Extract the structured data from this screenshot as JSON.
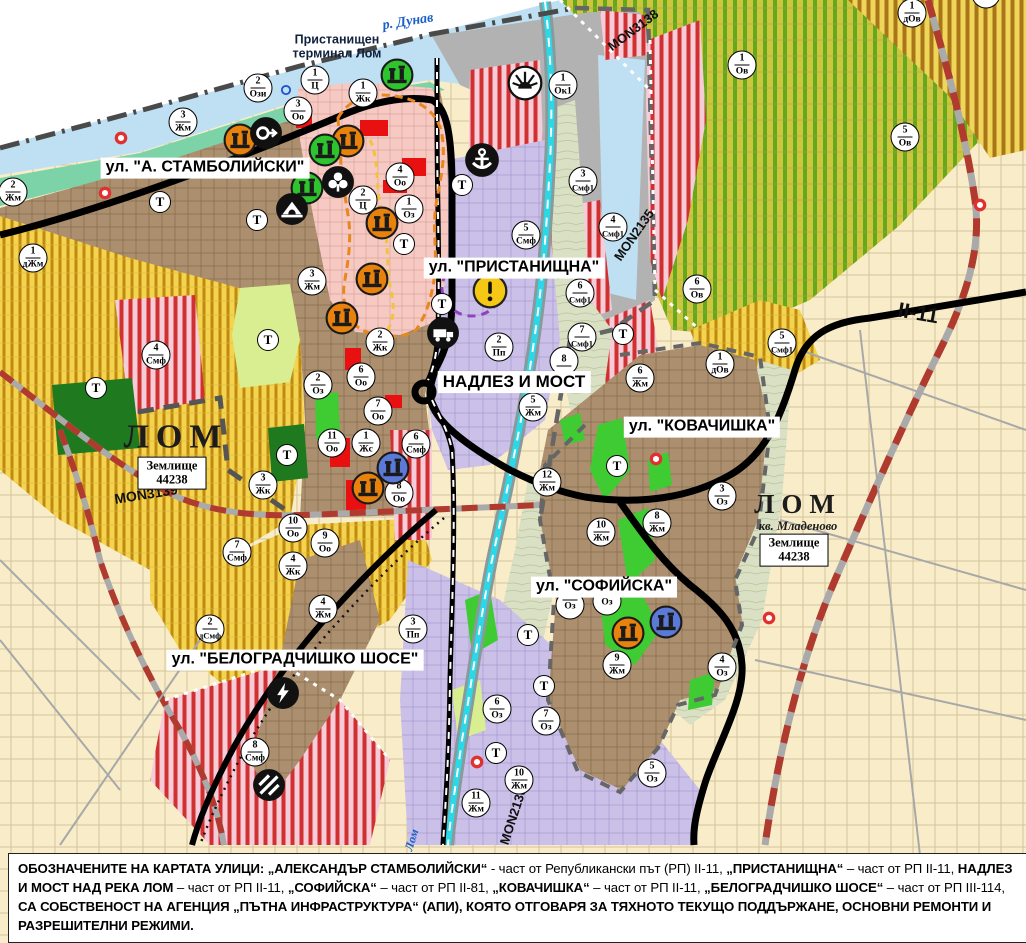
{
  "map": {
    "street_labels": [
      {
        "t": "ул. \"А. СТАМБОЛИЙСКИ\"",
        "x": 205,
        "y": 168,
        "fs": 16
      },
      {
        "t": "ул. \"ПРИСТАНИЩНА\"",
        "x": 514,
        "y": 268,
        "fs": 16
      },
      {
        "t": "НАДЛЕЗ И МОСТ",
        "x": 514,
        "y": 382,
        "fs": 17
      },
      {
        "t": "ул. \"КОВАЧИШКА\"",
        "x": 702,
        "y": 427,
        "fs": 16
      },
      {
        "t": "ул. \"СОФИЙСКА\"",
        "x": 604,
        "y": 587,
        "fs": 16
      },
      {
        "t": "ул. \"БЕЛОГРАДЧИШКО ШОСЕ\"",
        "x": 295,
        "y": 660,
        "fs": 16
      }
    ],
    "road_labels": [
      {
        "t": "MON3138",
        "x": 633,
        "y": 30,
        "rot": -37,
        "fs": 13
      },
      {
        "t": "MON2135",
        "x": 634,
        "y": 235,
        "rot": -55,
        "fs": 13
      },
      {
        "t": "MON3139",
        "x": 146,
        "y": 494,
        "rot": -9,
        "fs": 14
      },
      {
        "t": "MON2136",
        "x": 513,
        "y": 816,
        "rot": -72,
        "fs": 13
      },
      {
        "t": "II-11",
        "x": 918,
        "y": 314,
        "rot": 10,
        "fs": 21
      }
    ],
    "text_labels": [
      {
        "t": "р. Дунав",
        "x": 408,
        "y": 22,
        "rot": -9,
        "cls": "river",
        "fs": 14
      },
      {
        "t": "Пристанищен\nтерминал Лом",
        "x": 337,
        "y": 47,
        "rot": 0,
        "cls": "terminal",
        "fs": 12.5
      },
      {
        "t": "ЛОМ",
        "x": 176,
        "y": 437,
        "rot": 0,
        "cls": "city",
        "fs": 34
      },
      {
        "t": "ЛОМ",
        "x": 798,
        "y": 505,
        "rot": 0,
        "cls": "city",
        "fs": 27
      },
      {
        "t": "кв. Младеново",
        "x": 798,
        "y": 527,
        "rot": 0,
        "cls": "district",
        "fs": 12.5
      },
      {
        "t": "Лом",
        "x": 412,
        "y": 840,
        "rot": -73,
        "cls": "river",
        "fs": 12
      }
    ],
    "boxed_labels": [
      {
        "t": "Землище\n44238",
        "x": 172,
        "y": 473
      },
      {
        "t": "Землище\n44238",
        "x": 794,
        "y": 550
      }
    ],
    "t_label": "Т",
    "t_markers": [
      [
        160,
        202
      ],
      [
        257,
        220
      ],
      [
        462,
        185
      ],
      [
        404,
        244
      ],
      [
        442,
        304
      ],
      [
        268,
        340
      ],
      [
        96,
        388
      ],
      [
        287,
        455
      ],
      [
        623,
        334
      ],
      [
        617,
        466
      ],
      [
        528,
        635
      ],
      [
        544,
        686
      ],
      [
        496,
        753
      ]
    ],
    "zone_markers": [
      {
        "n": "2",
        "c": "Ози",
        "x": 258,
        "y": 88
      },
      {
        "n": "1",
        "c": "Ц",
        "x": 315,
        "y": 80
      },
      {
        "n": "1",
        "c": "Жк",
        "x": 363,
        "y": 93
      },
      {
        "n": "3",
        "c": "Оо",
        "x": 298,
        "y": 111
      },
      {
        "n": "3",
        "c": "Жм",
        "x": 183,
        "y": 122
      },
      {
        "n": "2",
        "c": "Жм",
        "x": 13,
        "y": 192
      },
      {
        "n": "1",
        "c": "дЖм",
        "x": 33,
        "y": 258
      },
      {
        "n": "4",
        "c": "Оо",
        "x": 400,
        "y": 177
      },
      {
        "n": "2",
        "c": "Ц",
        "x": 363,
        "y": 200
      },
      {
        "n": "1",
        "c": "Оз",
        "x": 409,
        "y": 209
      },
      {
        "n": "3",
        "c": "Жм",
        "x": 312,
        "y": 281
      },
      {
        "n": "1",
        "c": "Ок1",
        "x": 563,
        "y": 85
      },
      {
        "n": "1",
        "c": "Ов",
        "x": 742,
        "y": 65
      },
      {
        "n": "5",
        "c": "Ов",
        "x": 905,
        "y": 137
      },
      {
        "n": "1",
        "c": "дОв",
        "x": 912,
        "y": 13
      },
      {
        "n": "",
        "c": "дОв",
        "x": 986,
        "y": -6
      },
      {
        "n": "3",
        "c": "Смф1",
        "x": 583,
        "y": 181
      },
      {
        "n": "4",
        "c": "Смф1",
        "x": 613,
        "y": 227
      },
      {
        "n": "5",
        "c": "Смф",
        "x": 526,
        "y": 235
      },
      {
        "n": "6",
        "c": "Ов",
        "x": 697,
        "y": 289
      },
      {
        "n": "5",
        "c": "Смф1",
        "x": 782,
        "y": 343
      },
      {
        "n": "1",
        "c": "дОв",
        "x": 720,
        "y": 364
      },
      {
        "n": "6",
        "c": "Смф1",
        "x": 580,
        "y": 293
      },
      {
        "n": "7",
        "c": "Смф1",
        "x": 582,
        "y": 337
      },
      {
        "n": "2",
        "c": "Пп",
        "x": 499,
        "y": 347
      },
      {
        "n": "8",
        "c": "",
        "x": 564,
        "y": 361
      },
      {
        "n": "5",
        "c": "Жм",
        "x": 533,
        "y": 407
      },
      {
        "n": "6",
        "c": "Жм",
        "x": 640,
        "y": 378
      },
      {
        "n": "2",
        "c": "Оз",
        "x": 318,
        "y": 385
      },
      {
        "n": "6",
        "c": "Оо",
        "x": 361,
        "y": 377
      },
      {
        "n": "2",
        "c": "Жк",
        "x": 380,
        "y": 342
      },
      {
        "n": "7",
        "c": "Оо",
        "x": 378,
        "y": 411
      },
      {
        "n": "11",
        "c": "Оо",
        "x": 332,
        "y": 443
      },
      {
        "n": "1",
        "c": "Жс",
        "x": 366,
        "y": 443
      },
      {
        "n": "6",
        "c": "Смф",
        "x": 416,
        "y": 444
      },
      {
        "n": "8",
        "c": "Оо",
        "x": 399,
        "y": 493
      },
      {
        "n": "3",
        "c": "Жк",
        "x": 263,
        "y": 485
      },
      {
        "n": "10",
        "c": "Оо",
        "x": 293,
        "y": 528
      },
      {
        "n": "9",
        "c": "Оо",
        "x": 325,
        "y": 543
      },
      {
        "n": "4",
        "c": "Жк",
        "x": 293,
        "y": 566
      },
      {
        "n": "7",
        "c": "Смф",
        "x": 237,
        "y": 552
      },
      {
        "n": "4",
        "c": "Смф",
        "x": 156,
        "y": 355
      },
      {
        "n": "12",
        "c": "Жм",
        "x": 547,
        "y": 482
      },
      {
        "n": "3",
        "c": "Оз",
        "x": 722,
        "y": 496
      },
      {
        "n": "8",
        "c": "Жм",
        "x": 657,
        "y": 523
      },
      {
        "n": "10",
        "c": "Жм",
        "x": 601,
        "y": 532
      },
      {
        "n": "9",
        "c": "Жм",
        "x": 617,
        "y": 665
      },
      {
        "n": "4",
        "c": "Оз",
        "x": 722,
        "y": 667
      },
      {
        "n": "6",
        "c": "Оз",
        "x": 497,
        "y": 709
      },
      {
        "n": "7",
        "c": "Оз",
        "x": 546,
        "y": 721
      },
      {
        "n": "10",
        "c": "Жм",
        "x": 519,
        "y": 780
      },
      {
        "n": "11",
        "c": "Жм",
        "x": 476,
        "y": 803
      },
      {
        "n": "5",
        "c": "Оз",
        "x": 652,
        "y": 773
      },
      {
        "n": "4",
        "c": "Жм",
        "x": 323,
        "y": 609
      },
      {
        "n": "2",
        "c": "дСмф",
        "x": 210,
        "y": 629
      },
      {
        "n": "3",
        "c": "Пп",
        "x": 413,
        "y": 629
      },
      {
        "n": "8",
        "c": "Смф",
        "x": 255,
        "y": 752
      },
      {
        "n": "",
        "c": "Оз",
        "x": 570,
        "y": 605
      },
      {
        "n": "",
        "c": "Оз",
        "x": 607,
        "y": 601
      }
    ],
    "icons": [
      {
        "type": "landmark",
        "color": "#E8820C",
        "x": 240,
        "y": 140
      },
      {
        "type": "landmark",
        "color": "#E8820C",
        "x": 348,
        "y": 141
      },
      {
        "type": "landmark",
        "color": "#E8820C",
        "x": 382,
        "y": 223
      },
      {
        "type": "landmark",
        "color": "#E8820C",
        "x": 372,
        "y": 279
      },
      {
        "type": "landmark",
        "color": "#E8820C",
        "x": 342,
        "y": 318
      },
      {
        "type": "landmark",
        "color": "#E8820C",
        "x": 368,
        "y": 488
      },
      {
        "type": "landmark",
        "color": "#E8820C",
        "x": 628,
        "y": 633
      },
      {
        "type": "landmark",
        "color": "#2EC42E",
        "x": 397,
        "y": 75
      },
      {
        "type": "landmark",
        "color": "#2EC42E",
        "x": 325,
        "y": 150
      },
      {
        "type": "landmark",
        "color": "#2EC42E",
        "x": 307,
        "y": 188
      },
      {
        "type": "landmark",
        "color": "#5B79D6",
        "x": 393,
        "y": 468
      },
      {
        "type": "landmark",
        "color": "#5B79D6",
        "x": 666,
        "y": 622
      },
      {
        "type": "anchor",
        "x": 482,
        "y": 160
      },
      {
        "type": "roundabout",
        "x": 266,
        "y": 133
      },
      {
        "type": "clover",
        "x": 338,
        "y": 182
      },
      {
        "type": "tunnel",
        "x": 292,
        "y": 209
      },
      {
        "type": "truck",
        "x": 443,
        "y": 333
      },
      {
        "type": "warning",
        "x": 490,
        "y": 291
      },
      {
        "type": "sun",
        "x": 525,
        "y": 83
      },
      {
        "type": "lightning",
        "x": 283,
        "y": 693
      },
      {
        "type": "crossing",
        "x": 269,
        "y": 785
      },
      {
        "type": "reddot",
        "x": 121,
        "y": 138
      },
      {
        "type": "reddot",
        "x": 105,
        "y": 193
      },
      {
        "type": "reddot",
        "x": 656,
        "y": 459
      },
      {
        "type": "reddot",
        "x": 769,
        "y": 618
      },
      {
        "type": "reddot",
        "x": 477,
        "y": 762
      },
      {
        "type": "reddot",
        "x": 980,
        "y": 205
      },
      {
        "type": "bluering",
        "x": 286,
        "y": 90
      }
    ]
  },
  "footer": {
    "segments": [
      {
        "b": 1,
        "t": "ОБОЗНАЧЕНИТЕ НА КАРТАТА УЛИЦИ: "
      },
      {
        "b": 1,
        "t": "„АЛЕКСАНДЪР СТАМБОЛИЙСКИ“"
      },
      {
        "b": 0,
        "t": " - част от Републикански път (РП) II-11, "
      },
      {
        "b": 1,
        "t": "„ПРИСТАНИЩНА“"
      },
      {
        "b": 0,
        "t": " – част от РП II-11, "
      },
      {
        "b": 1,
        "t": "НАДЛЕЗ И МОСТ НАД РЕКА ЛОМ"
      },
      {
        "b": 0,
        "t": " – част от РП II-11, "
      },
      {
        "b": 1,
        "t": "„СОФИЙСКА“"
      },
      {
        "b": 0,
        "t": " – част от РП II-81, "
      },
      {
        "b": 1,
        "t": "„КОВАЧИШКА“"
      },
      {
        "b": 0,
        "t": " – част от РП II-11, "
      },
      {
        "b": 1,
        "t": "„БЕЛОГРАДЧИШКО ШОСЕ“"
      },
      {
        "b": 0,
        "t": " – част от РП III-114, "
      },
      {
        "b": 1,
        "t": "СА СОБСТВЕНОСТ НА АГЕНЦИЯ „ПЪТНА ИНФРАСТРУКТУРА“ (АПИ), КОЯТО ОТГОВАРЯ ЗА ТЯХНОТО ТЕКУЩО ПОДДЪРЖАНЕ, ОСНОВНИ РЕМОНТИ И РАЗРЕШИТЕЛНИ РЕЖИМИ."
      }
    ]
  }
}
